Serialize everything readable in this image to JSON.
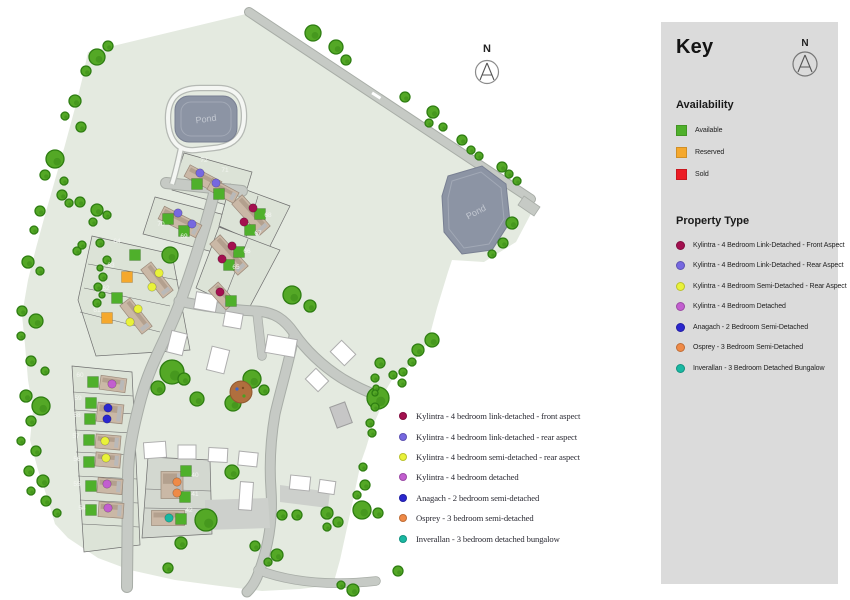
{
  "colors": {
    "status": {
      "available": "#4FB02B",
      "reserved": "#F5A82D",
      "sold": "#EC1C24"
    },
    "types": {
      "front": "#A3104F",
      "rear": "#7668E0",
      "semi_rear": "#E9F23A",
      "detached": "#C25ECF",
      "anagach": "#2B27CE",
      "osprey": "#EF8A47",
      "inverallan": "#19B8A2"
    },
    "panel_bg": "#DBDBDB",
    "site_green": "#E4EAE0",
    "pond": "#8C94A4"
  },
  "key_panel": {
    "title": "Key",
    "north_label": "N",
    "availability": {
      "heading": "Availability",
      "items": [
        {
          "label": "Available",
          "status": "available"
        },
        {
          "label": "Reserved",
          "status": "reserved"
        },
        {
          "label": "Sold",
          "status": "sold"
        }
      ]
    },
    "property_type": {
      "heading": "Property Type",
      "items": [
        {
          "label": "Kylintra - 4 Bedroom Link-Detached - Front Aspect",
          "type": "front"
        },
        {
          "label": "Kylintra - 4 Bedroom Link-Detached - Rear Aspect",
          "type": "rear"
        },
        {
          "label": "Kylintra - 4 Bedroom Semi-Detached - Rear Aspect",
          "type": "semi_rear"
        },
        {
          "label": "Kylintra - 4 Bedroom Detached",
          "type": "detached"
        },
        {
          "label": "Anagach - 2 Bedroom Semi-Detached",
          "type": "anagach"
        },
        {
          "label": "Osprey - 3 Bedroom Semi-Detached",
          "type": "osprey"
        },
        {
          "label": "Inverallan - 3 Bedroom Detached Bungalow",
          "type": "inverallan"
        }
      ]
    }
  },
  "overlay_legend": {
    "items": [
      {
        "label": "Kylintra - 4 bedroom link-detached - front aspect",
        "type": "front"
      },
      {
        "label": "Kylintra - 4 bedroom link-detached - rear aspect",
        "type": "rear"
      },
      {
        "label": "Kylintra - 4 bedroom semi-detached - rear aspect",
        "type": "semi_rear"
      },
      {
        "label": "Kylintra - 4 bedroom detached",
        "type": "detached"
      },
      {
        "label": "Anagach - 2 bedroom semi-detached",
        "type": "anagach"
      },
      {
        "label": "Osprey - 3 bedroom semi-detached",
        "type": "osprey"
      },
      {
        "label": "Inverallan - 3 bedroom detached bungalow",
        "type": "inverallan"
      }
    ]
  },
  "map": {
    "north_label": "N",
    "pond1_label": "Pond",
    "pond2_label": "Pond",
    "plots": [
      {
        "num": "72",
        "label": [
          204,
          162
        ],
        "square": [
          197,
          184
        ],
        "status": "available",
        "dot": [
          200,
          173
        ],
        "type": "rear"
      },
      {
        "num": "71",
        "label": [
          225,
          172
        ],
        "square": [
          219,
          194
        ],
        "status": "available",
        "dot": [
          216,
          183
        ],
        "type": "rear"
      },
      {
        "num": "70",
        "label": [
          161,
          226
        ],
        "square": [
          168,
          219
        ],
        "status": "available",
        "dot": [
          178,
          213
        ],
        "type": "rear"
      },
      {
        "num": "69",
        "label": [
          184,
          238
        ],
        "square": [
          184,
          231
        ],
        "status": "available",
        "dot": [
          192,
          224
        ],
        "type": "rear"
      },
      {
        "num": "68",
        "label": [
          268,
          217
        ],
        "square": [
          260,
          214
        ],
        "status": "available",
        "dot": [
          253,
          208
        ],
        "type": "front"
      },
      {
        "num": "67",
        "label": [
          258,
          235
        ],
        "square": [
          250,
          230
        ],
        "status": "available",
        "dot": [
          244,
          222
        ],
        "type": "front"
      },
      {
        "num": "66",
        "label": [
          247,
          253
        ],
        "square": [
          239,
          252
        ],
        "status": "available",
        "dot": [
          232,
          246
        ],
        "type": "front"
      },
      {
        "num": "65",
        "label": [
          236,
          269
        ],
        "square": [
          229,
          265
        ],
        "status": "available",
        "dot": [
          222,
          259
        ],
        "type": "front"
      },
      {
        "num": "",
        "label": null,
        "square": [
          231,
          301
        ],
        "status": "available",
        "dot": [
          220,
          292
        ],
        "type": "front"
      },
      {
        "num": "64",
        "label": [
          117,
          243
        ],
        "square": [
          135,
          255
        ],
        "status": "available",
        "dot": [
          159,
          273
        ],
        "type": "semi_rear"
      },
      {
        "num": "63",
        "label": [
          111,
          267
        ],
        "square": [
          127,
          277
        ],
        "status": "reserved",
        "dot": [
          152,
          287
        ],
        "type": "semi_rear"
      },
      {
        "num": "62",
        "label": [
          106,
          290
        ],
        "square": [
          117,
          298
        ],
        "status": "available",
        "dot": [
          138,
          309
        ],
        "type": "semi_rear"
      },
      {
        "num": "61",
        "label": [
          97,
          312
        ],
        "square": [
          107,
          318
        ],
        "status": "reserved",
        "dot": [
          130,
          322
        ],
        "type": "semi_rear"
      },
      {
        "num": "60",
        "label": [
          80,
          377
        ],
        "square": [
          93,
          382
        ],
        "status": "available",
        "dot": [
          112,
          384
        ],
        "type": "detached"
      },
      {
        "num": "59",
        "label": [
          78,
          400
        ],
        "square": [
          91,
          403
        ],
        "status": "available",
        "dot": [
          108,
          408
        ],
        "type": "anagach"
      },
      {
        "num": "58",
        "label": [
          77,
          417
        ],
        "square": [
          90,
          419
        ],
        "status": "available",
        "dot": [
          107,
          419
        ],
        "type": "anagach"
      },
      {
        "num": "57",
        "label": [
          76,
          438
        ],
        "square": [
          89,
          440
        ],
        "status": "available",
        "dot": [
          105,
          441
        ],
        "type": "semi_rear"
      },
      {
        "num": "56",
        "label": [
          77,
          461
        ],
        "square": [
          89,
          462
        ],
        "status": "available",
        "dot": [
          106,
          458
        ],
        "type": "semi_rear"
      },
      {
        "num": "55",
        "label": [
          77,
          486
        ],
        "square": [
          91,
          486
        ],
        "status": "available",
        "dot": [
          107,
          484
        ],
        "type": "detached"
      },
      {
        "num": "54",
        "label": [
          82,
          510
        ],
        "square": [
          91,
          510
        ],
        "status": "available",
        "dot": [
          108,
          508
        ],
        "type": "detached"
      },
      {
        "num": "40",
        "label": [
          195,
          477
        ],
        "square": [
          186,
          471
        ],
        "status": "available",
        "dot": [
          177,
          482
        ],
        "type": "osprey"
      },
      {
        "num": "41",
        "label": [
          195,
          496
        ],
        "square": [
          185,
          497
        ],
        "status": "available",
        "dot": [
          177,
          493
        ],
        "type": "osprey"
      },
      {
        "num": "42",
        "label": [
          189,
          512
        ],
        "square": [
          181,
          519
        ],
        "status": "available",
        "dot": [
          169,
          518
        ],
        "type": "inverallan"
      }
    ]
  }
}
